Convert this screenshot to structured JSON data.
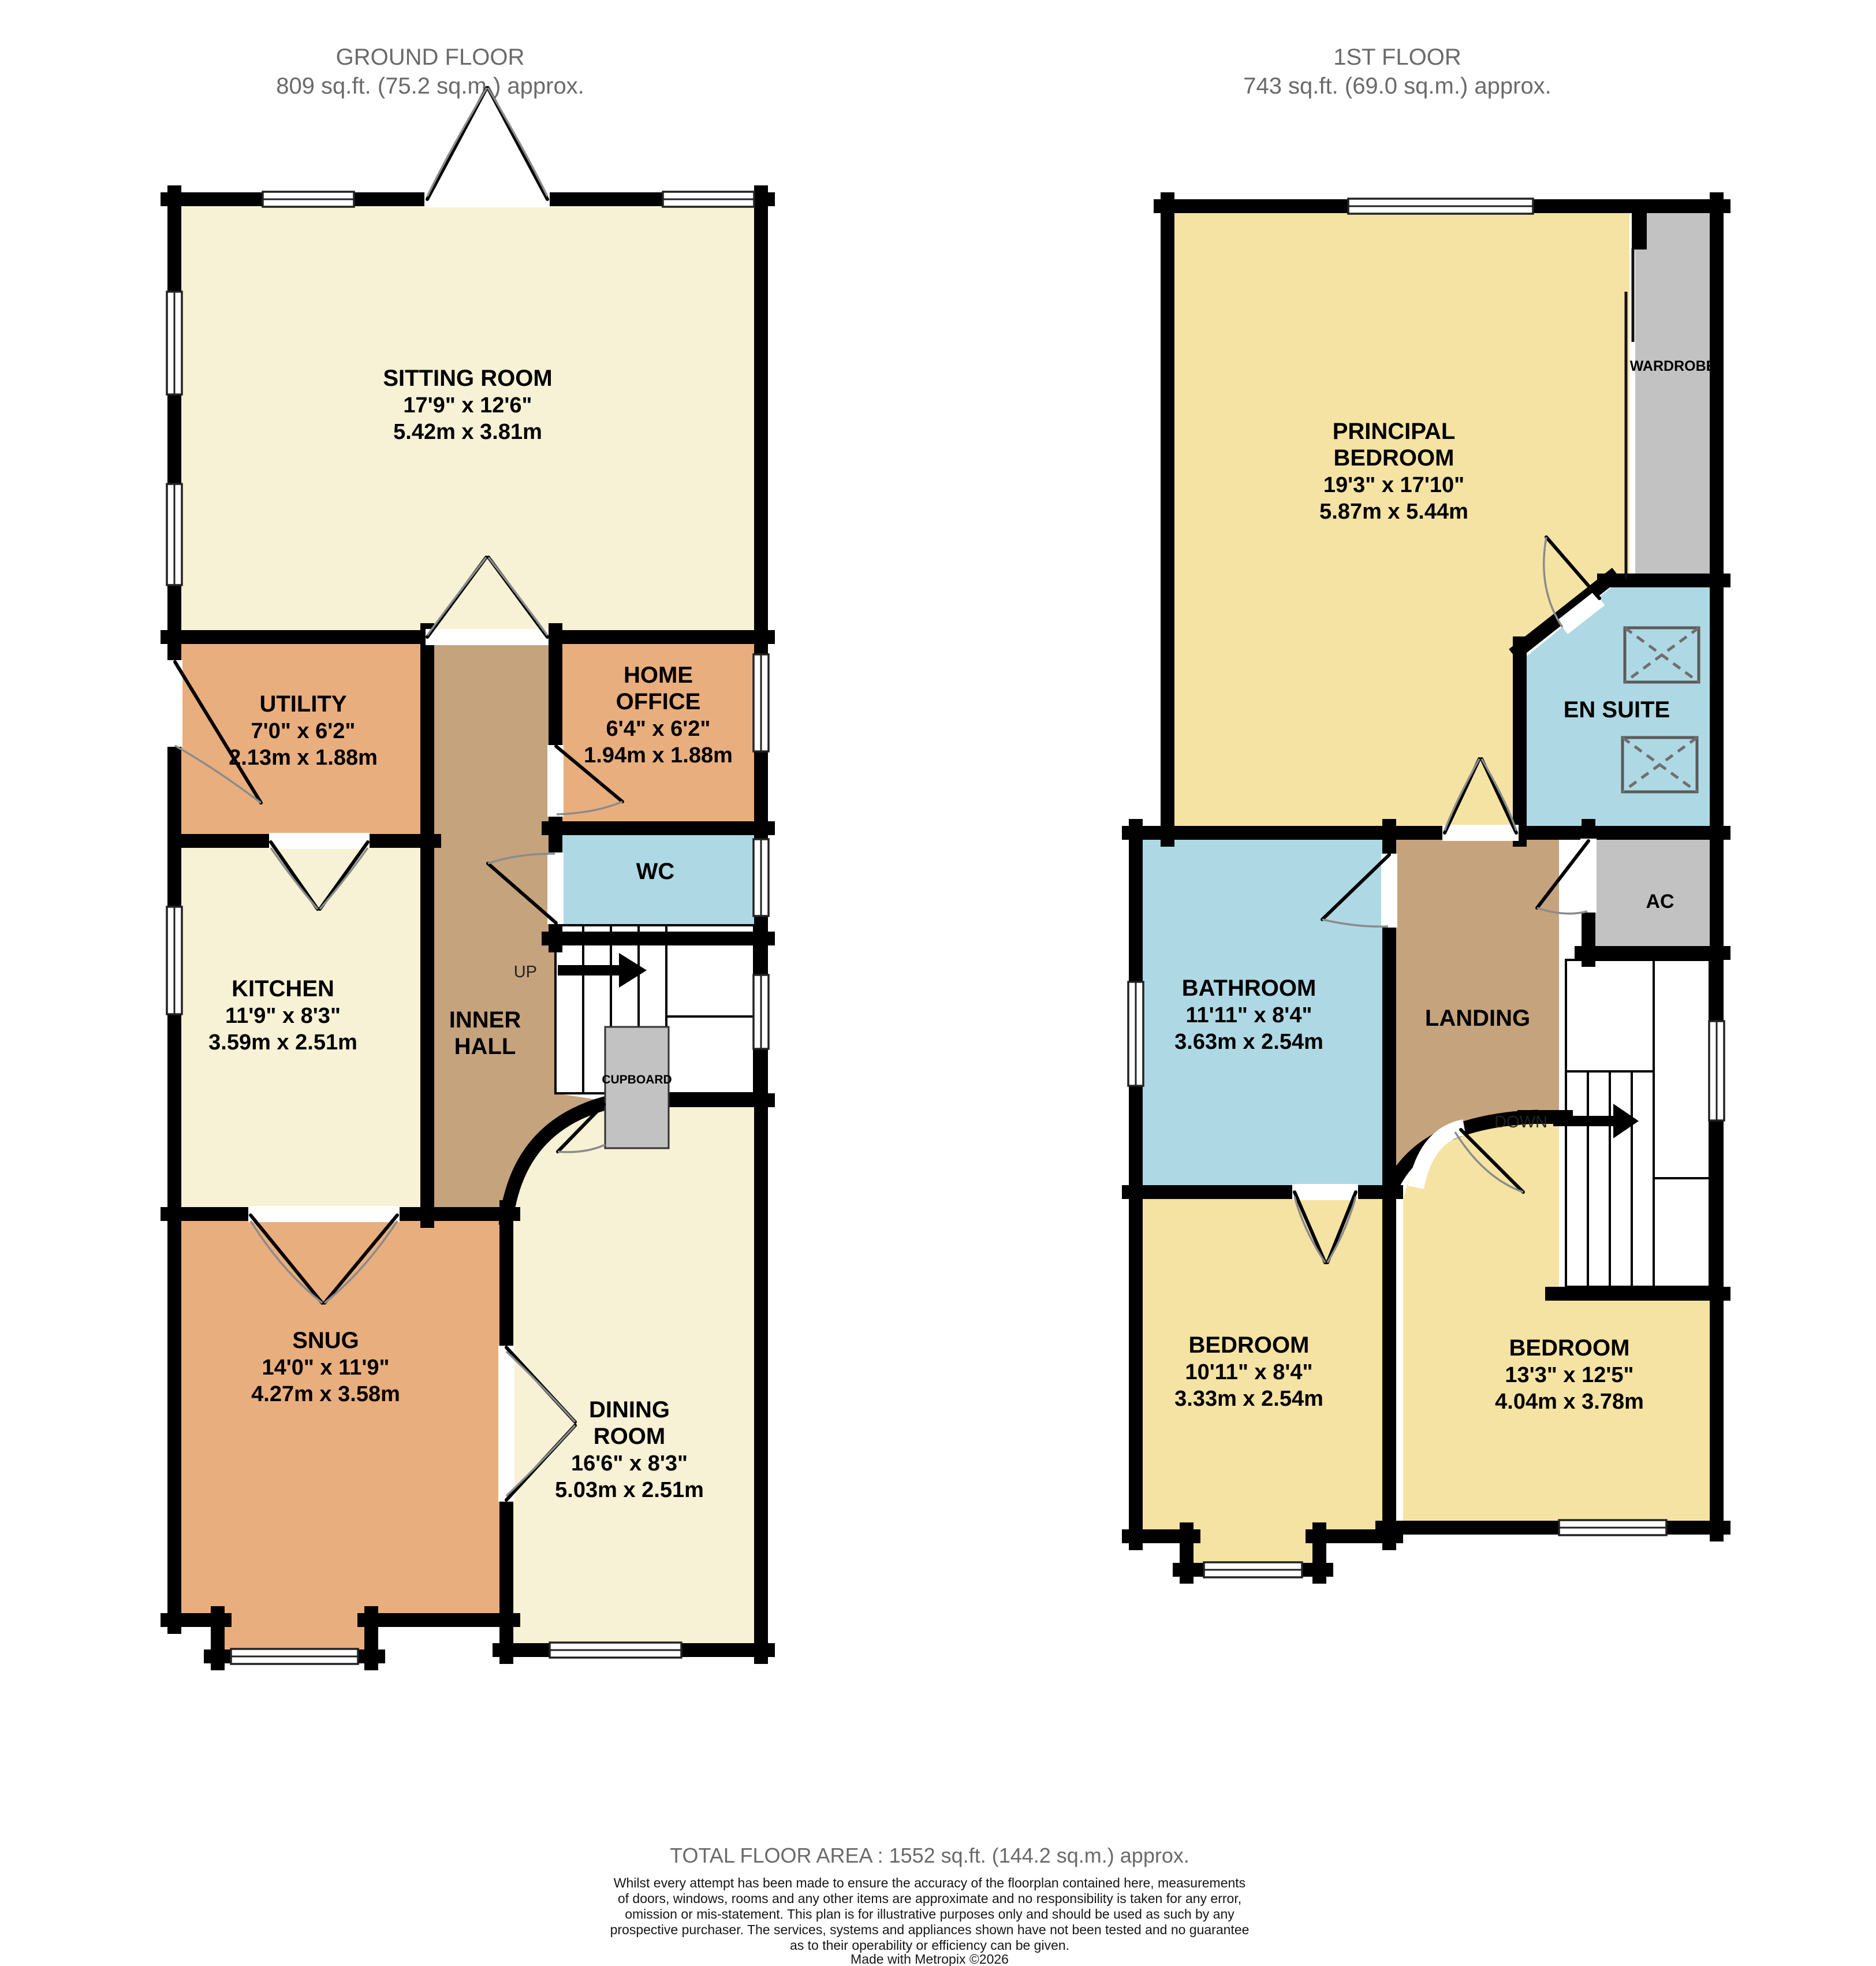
{
  "headers": {
    "ground": {
      "title": "GROUND FLOOR",
      "area": "809 sq.ft. (75.2 sq.m.) approx."
    },
    "first": {
      "title": "1ST FLOOR",
      "area": "743 sq.ft. (69.0 sq.m.) approx."
    }
  },
  "colors": {
    "cream": "#F7F1D5",
    "orange": "#E9AE7E",
    "tan": "#C5A37C",
    "blue": "#AED9E4",
    "yellow": "#F5E3A3",
    "gray": "#C2C2C2",
    "wall": "#000000",
    "white": "#FFFFFF"
  },
  "ground_floor": {
    "rooms": {
      "sitting_room": {
        "name": "SITTING ROOM",
        "imperial": "17'9\"  x 12'6\"",
        "metric": "5.42m  x 3.81m"
      },
      "utility": {
        "name": "UTILITY",
        "imperial": "7'0\"  x 6'2\"",
        "metric": "2.13m  x 1.88m"
      },
      "home_office": {
        "name1": "HOME",
        "name2": "OFFICE",
        "imperial": "6'4\"  x 6'2\"",
        "metric": "1.94m  x 1.88m"
      },
      "wc": {
        "name": "WC"
      },
      "kitchen": {
        "name": "KITCHEN",
        "imperial": "11'9\"  x 8'3\"",
        "metric": "3.59m  x 2.51m"
      },
      "inner_hall": {
        "name1": "INNER",
        "name2": "HALL"
      },
      "cupboard": {
        "name": "CUPBOARD"
      },
      "snug": {
        "name": "SNUG",
        "imperial": "14'0\"  x 11'9\"",
        "metric": "4.27m  x 3.58m"
      },
      "dining_room": {
        "name1": "DINING",
        "name2": "ROOM",
        "imperial": "16'6\"  x 8'3\"",
        "metric": "5.03m  x 2.51m"
      }
    },
    "stairs_label": "UP"
  },
  "first_floor": {
    "rooms": {
      "principal_bedroom": {
        "name1": "PRINCIPAL",
        "name2": "BEDROOM",
        "imperial": "19'3\"  x 17'10\"",
        "metric": "5.87m  x 5.44m"
      },
      "wardrobe": {
        "name": "WARDROBE"
      },
      "en_suite": {
        "name": "EN SUITE"
      },
      "bathroom": {
        "name": "BATHROOM",
        "imperial": "11'11\"  x 8'4\"",
        "metric": "3.63m  x 2.54m"
      },
      "landing": {
        "name": "LANDING"
      },
      "ac": {
        "name": "AC"
      },
      "bedroom_left": {
        "name": "BEDROOM",
        "imperial": "10'11\"  x 8'4\"",
        "metric": "3.33m  x 2.54m"
      },
      "bedroom_right": {
        "name": "BEDROOM",
        "imperial": "13'3\"  x 12'5\"",
        "metric": "4.04m  x 3.78m"
      }
    },
    "stairs_label": "DOWN"
  },
  "footer": {
    "total": "TOTAL FLOOR AREA : 1552 sq.ft. (144.2 sq.m.) approx.",
    "disclaimer_lines": [
      "Whilst every attempt has been made to ensure the accuracy of the floorplan contained here, measurements",
      "of doors, windows, rooms and any other items are approximate and no responsibility is taken for any error,",
      "omission or mis-statement. This plan is for illustrative purposes only and should be used as such by any",
      "prospective purchaser. The services, systems and appliances shown have not been tested and no guarantee",
      "as to their operability or efficiency can be given."
    ],
    "credit": "Made with Metropix ©2026"
  }
}
